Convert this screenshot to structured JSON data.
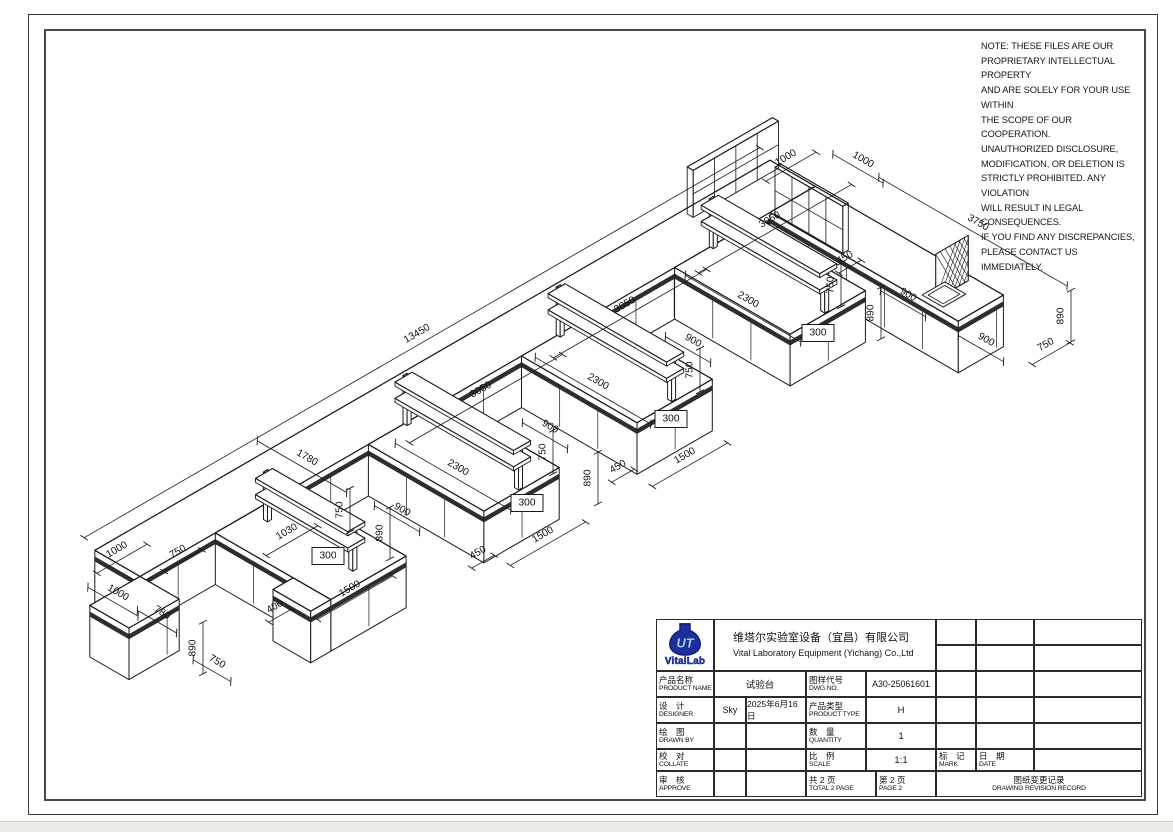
{
  "note": {
    "lines": [
      "NOTE:  THESE FILES ARE OUR",
      "PROPRIETARY INTELLECTUAL PROPERTY",
      "AND ARE SOLELY FOR YOUR USE WITHIN",
      "THE SCOPE OF OUR COOPERATION.",
      "UNAUTHORIZED DISCLOSURE,",
      "MODIFICATION, OR DELETION IS",
      "STRICTLY PROHIBITED. ANY VIOLATION",
      "WILL RESULT IN LEGAL CONSEQUENCES.",
      "IF YOU FIND ANY DISCREPANCIES,",
      "PLEASE CONTACT US IMMEDIATELY."
    ]
  },
  "title_block": {
    "logo_text": "VitalLab",
    "logo_monogram": "UT",
    "company_cn": "维塔尔实验室设备（宜昌）有限公司",
    "company_en": "Vital Laboratory Equipment (Yichang) Co.,Ltd",
    "product_name": {
      "label_cn": "产品名称",
      "label_en": "PRODUCT NAME",
      "value": "试验台"
    },
    "dwg_no": {
      "label_cn": "图样代号",
      "label_en": "DWG.NO.",
      "value": "A30-25061601"
    },
    "designer": {
      "label_cn": "设　计",
      "label_en": "DESIGNER",
      "value": "Sky",
      "date": "2025年6月16日"
    },
    "product_type": {
      "label_cn": "产品类型",
      "label_en": "PRODUCT TYPE",
      "value": "H"
    },
    "drawn_by": {
      "label_cn": "绘　图",
      "label_en": "DRAWN BY",
      "value": ""
    },
    "quantity": {
      "label_cn": "数　量",
      "label_en": "QUANTITY",
      "value": "1"
    },
    "collate": {
      "label_cn": "校　对",
      "label_en": "COLLATE",
      "value": ""
    },
    "scale": {
      "label_cn": "比　例",
      "label_en": "SCALE",
      "value": "1:1"
    },
    "approve": {
      "label_cn": "审　核",
      "label_en": "APPROVE",
      "value": ""
    },
    "total_page": {
      "label_cn": "共 2 页",
      "label_en": "TOTAL 2 PAGE"
    },
    "page": {
      "label_cn": "第 2 页",
      "label_en": "PAGE 2"
    },
    "mark": {
      "label_cn": "标　记",
      "label_en": "MARK"
    },
    "date": {
      "label_cn": "日　期",
      "label_en": "DATE"
    },
    "revision": {
      "label_cn": "图纸变更记录",
      "label_en": "DRAWING REVISION RECORD"
    }
  },
  "drawing": {
    "accent_line_color": "#191919",
    "dimensions": [
      {
        "t": "13450",
        "x": 417,
        "y": 334,
        "r": -30
      },
      {
        "t": "3050",
        "x": 481,
        "y": 390,
        "r": -30
      },
      {
        "t": "3050",
        "x": 625,
        "y": 305,
        "r": -30
      },
      {
        "t": "3050",
        "x": 770,
        "y": 220,
        "r": -30
      },
      {
        "t": "1500",
        "x": 350,
        "y": 589,
        "r": -30
      },
      {
        "t": "1500",
        "x": 543,
        "y": 535,
        "r": -30
      },
      {
        "t": "1500",
        "x": 685,
        "y": 456,
        "r": -30
      },
      {
        "t": "450",
        "x": 478,
        "y": 553,
        "r": -30
      },
      {
        "t": "450",
        "x": 618,
        "y": 467,
        "r": -30
      },
      {
        "t": "450",
        "x": 845,
        "y": 258,
        "r": -30
      },
      {
        "t": "1030",
        "x": 287,
        "y": 532,
        "r": -30
      },
      {
        "t": "400",
        "x": 275,
        "y": 607,
        "r": -30
      },
      {
        "t": "1000",
        "x": 117,
        "y": 550,
        "r": -30
      },
      {
        "t": "750",
        "x": 178,
        "y": 552,
        "r": -30
      },
      {
        "t": "1000",
        "x": 786,
        "y": 158,
        "r": -30
      },
      {
        "t": "750",
        "x": 1046,
        "y": 345,
        "r": -30
      },
      {
        "t": "2300",
        "x": 458,
        "y": 468,
        "r": 30
      },
      {
        "t": "2300",
        "x": 598,
        "y": 382,
        "r": 30
      },
      {
        "t": "2300",
        "x": 748,
        "y": 300,
        "r": 30
      },
      {
        "t": "1780",
        "x": 307,
        "y": 458,
        "r": 30
      },
      {
        "t": "900",
        "x": 402,
        "y": 510,
        "r": 30
      },
      {
        "t": "900",
        "x": 550,
        "y": 427,
        "r": 30
      },
      {
        "t": "900",
        "x": 693,
        "y": 341,
        "r": 30
      },
      {
        "t": "900",
        "x": 908,
        "y": 295,
        "r": 30
      },
      {
        "t": "900",
        "x": 986,
        "y": 340,
        "r": 30
      },
      {
        "t": "1000",
        "x": 863,
        "y": 160,
        "r": 30
      },
      {
        "t": "3750",
        "x": 978,
        "y": 223,
        "r": 30
      },
      {
        "t": "780",
        "x": 162,
        "y": 613,
        "r": 30
      },
      {
        "t": "1000",
        "x": 118,
        "y": 593,
        "r": 30
      },
      {
        "t": "750",
        "x": 217,
        "y": 662,
        "r": 30
      },
      {
        "t": "750",
        "x": 340,
        "y": 510,
        "r": -90
      },
      {
        "t": "750",
        "x": 543,
        "y": 452,
        "r": -90
      },
      {
        "t": "750",
        "x": 690,
        "y": 370,
        "r": -90
      },
      {
        "t": "750",
        "x": 831,
        "y": 285,
        "r": -90
      },
      {
        "t": "890",
        "x": 380,
        "y": 533,
        "r": -90
      },
      {
        "t": "890",
        "x": 588,
        "y": 478,
        "r": -90
      },
      {
        "t": "890",
        "x": 871,
        "y": 313,
        "r": -90
      },
      {
        "t": "890",
        "x": 1061,
        "y": 316,
        "r": -90
      },
      {
        "t": "890",
        "x": 193,
        "y": 648,
        "r": -90
      },
      {
        "t": "300",
        "x": 328,
        "y": 556,
        "r": 0,
        "box": true
      },
      {
        "t": "300",
        "x": 527,
        "y": 503,
        "r": 0,
        "box": true
      },
      {
        "t": "300",
        "x": 671,
        "y": 419,
        "r": 0,
        "box": true
      },
      {
        "t": "300",
        "x": 818,
        "y": 333,
        "r": 0,
        "box": true
      }
    ]
  }
}
